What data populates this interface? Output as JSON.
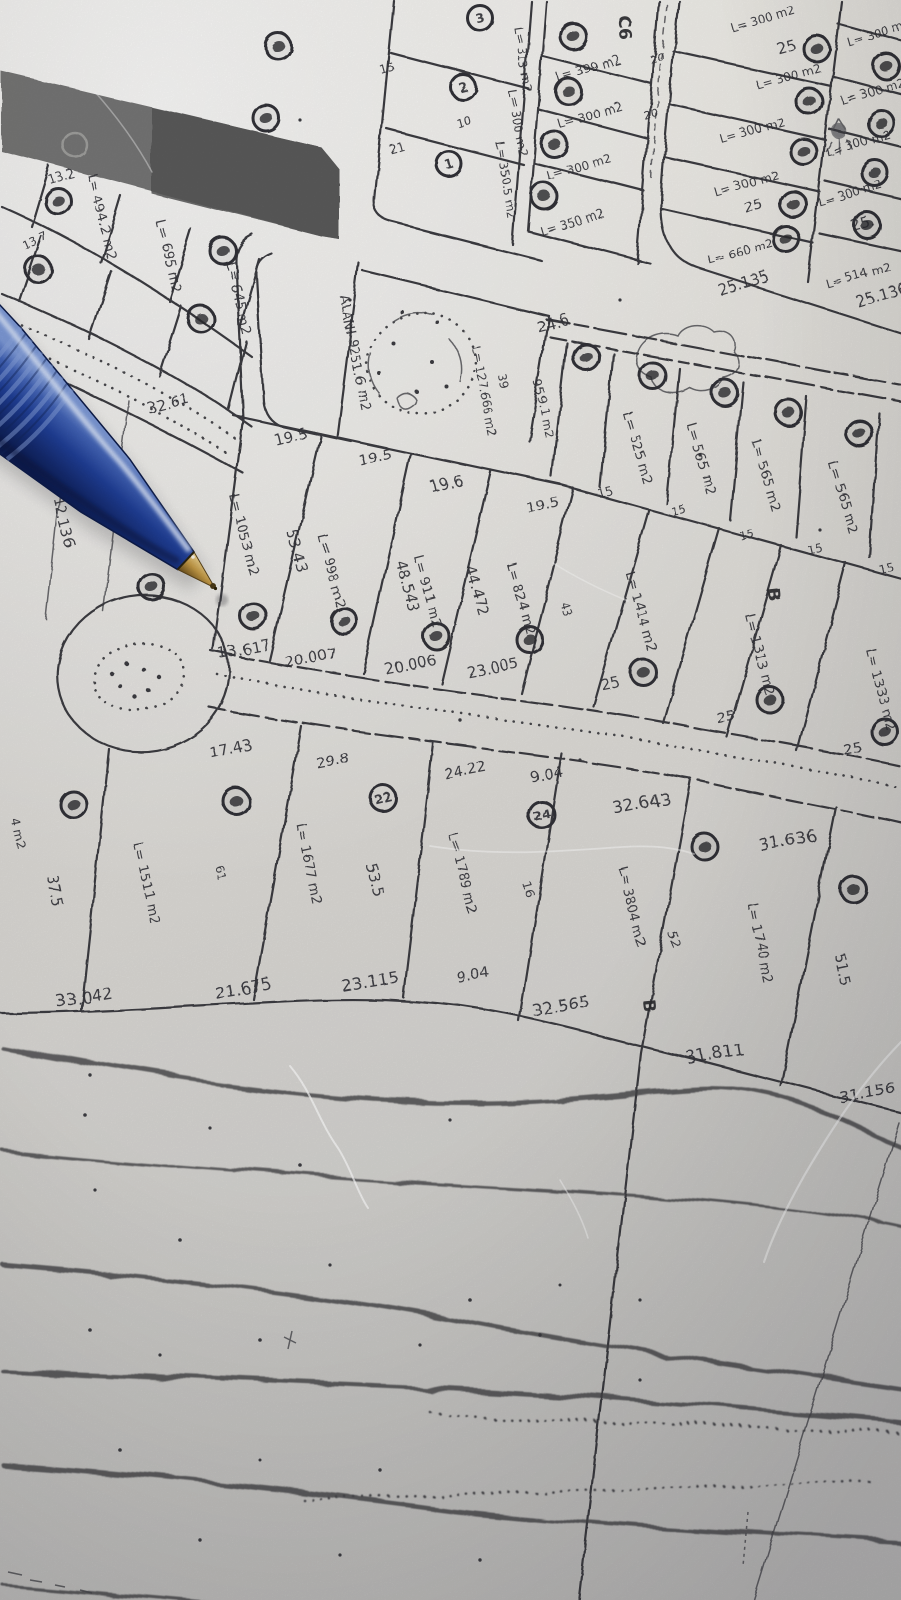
{
  "paper_color": "#dfddd8",
  "ink_color": "#3a3a3f",
  "pen_color": "#1e3d96",
  "blocks": {
    "c6": "C6",
    "b1": "B",
    "b2": "B"
  },
  "parcel_numbers": [
    "1",
    "2",
    "3",
    "22",
    "24"
  ],
  "park": {
    "label": "ALANI 9251.6 m2",
    "pool": "L= 127.666 m2",
    "right": "959.1 m2"
  },
  "dims": [
    "32.61",
    "19.5",
    "19.5",
    "19.6",
    "19.5",
    "15",
    "15",
    "15",
    "15",
    "15",
    "13.617",
    "20.007",
    "20.006",
    "23.005",
    "25",
    "25",
    "25",
    "17.43",
    "29.8",
    "24.22",
    "9.04",
    "32.643",
    "31.636",
    "33.042",
    "21.675",
    "23.115",
    "9.04",
    "32.565",
    "31.811",
    "31.156",
    "24.6",
    "25.135",
    "25.136",
    "25",
    "25.",
    "25",
    "12.136",
    "53.43",
    "48.543",
    "44.472",
    "43",
    "37.5",
    "61",
    "53.5",
    "16",
    "52",
    "51.5",
    "13.7",
    "13.2",
    "32.7",
    "15",
    "21",
    "10",
    "39",
    "20",
    "20"
  ],
  "areas": [
    "L= 494.2 m2",
    "L= 695 m2",
    "L= 645 m2",
    "L= 1053 m2",
    "L= 998 m2",
    "L= 911 m2",
    "L= 824 m2",
    "L= 1414 m2",
    "L= 1313 m2",
    "L= 1333 m2",
    "L= 525 m2",
    "L= 565 m2",
    "L= 565 m2",
    "L= 565 m2",
    "L= 1511 m2",
    "L= 1677 m2",
    "L= 1789 m2",
    "L= 3804 m2",
    "L= 1740 m2",
    "L= 399 m2",
    "L= 300 m2",
    "L= 300 m2",
    "L= 350 m2",
    "L= 300 m2",
    "L= 300 m2",
    "L= 300 m2",
    "L= 300 m2",
    "L= 660 m2",
    "L= 300 m2",
    "L= 300 m2",
    "L= 300 m2",
    "L= 300 m2",
    "L= 514 m2",
    "L= 313 m2",
    "L= 300 m2",
    "L= 350.5 m2",
    "4 m2"
  ]
}
